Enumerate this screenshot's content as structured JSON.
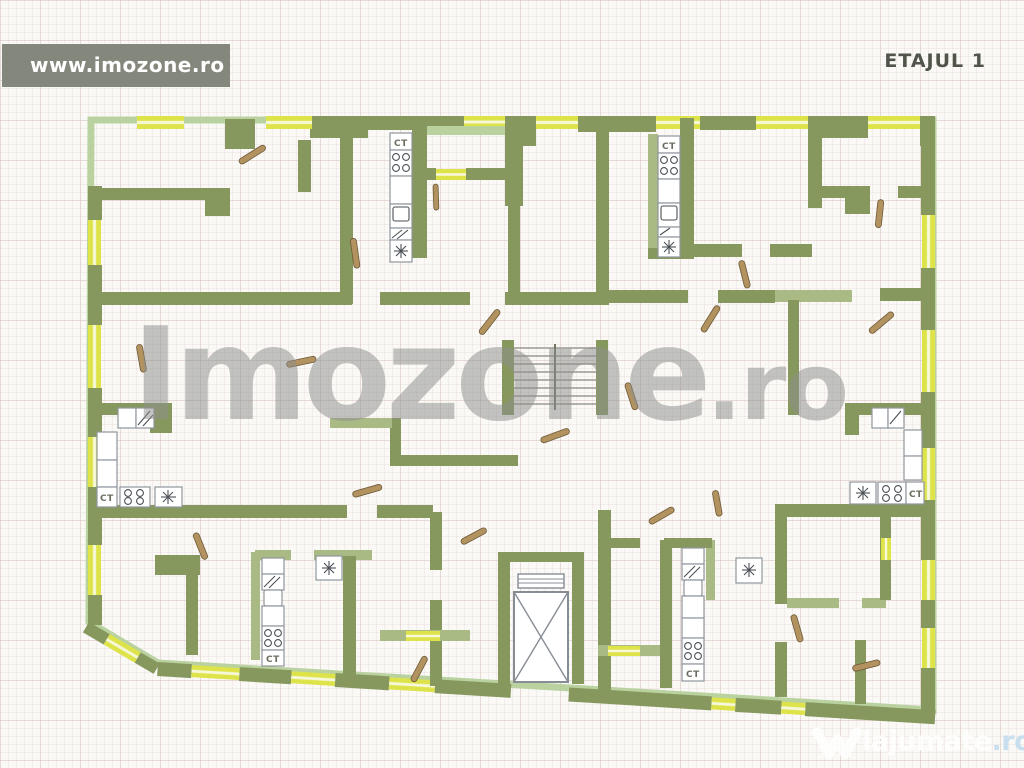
{
  "header": {
    "site_url": "www.imozone.ro",
    "floor_label": "ETAJUL 1"
  },
  "watermark": {
    "main": "Imozone",
    "suffix": ".ro"
  },
  "footer_logo": {
    "name": "lajumate",
    "tld": ".ro"
  },
  "plan": {
    "type": "apartment-building-floor-plan",
    "ct_label": "CT",
    "kitchen_count": 6,
    "has_elevator": true,
    "has_stairs": true
  },
  "colors": {
    "wall": "#87985f",
    "wall_light": "#a9ba85",
    "contour": "#b9d2a0",
    "window_yellow": "#dde348",
    "window_pale": "#f7f8da",
    "banner_bg": "#84877c",
    "banner_text": "#ffffff",
    "floor_label": "#50544a",
    "watermark": "#8f8f8d",
    "door": "#b2935f",
    "door_edge": "#6d5838",
    "fixture_edge": "#8f969e",
    "fixture_ink": "#4a4f55",
    "logo_tld": "#c2dcf0",
    "paper": "#faf9f6"
  }
}
